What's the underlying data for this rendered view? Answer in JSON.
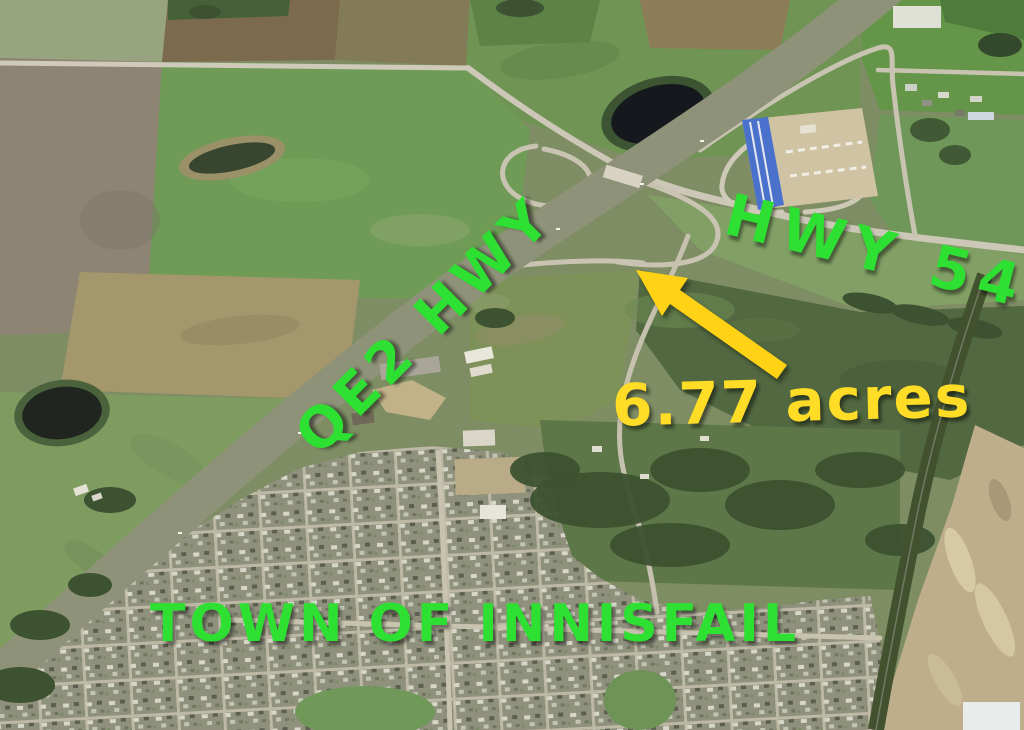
{
  "annotations": {
    "qe2_hwy": {
      "text": "QE2 HWY",
      "color": "#2de032"
    },
    "hwy_54": {
      "text": "HWY 54",
      "color": "#2de032"
    },
    "acreage": {
      "text": "6.77 acres",
      "color": "#ffdc26",
      "arrow": "arrow-pointing-up-left-to-parcel",
      "arrow_color": "#ffd215"
    },
    "town": {
      "text": "TOWN OF INNISFAIL",
      "color": "#2de032"
    }
  },
  "map": {
    "type": "satellite-aerial-photo",
    "features": [
      "qe2-highway-diagonal",
      "hwy-54-east-west",
      "highway-interchange-ramps",
      "overpass-bridge",
      "dark-pond-north",
      "pond-west",
      "field-slough",
      "patchwork-farm-fields",
      "rv-dealership-gravel-lot",
      "rural-acreages-northeast",
      "treed-acreage-parcel",
      "town-residential-street-grid",
      "parks",
      "railway-tree-corridor",
      "construction-gravel-site-southeast",
      "motel-buildings-by-highway"
    ]
  }
}
